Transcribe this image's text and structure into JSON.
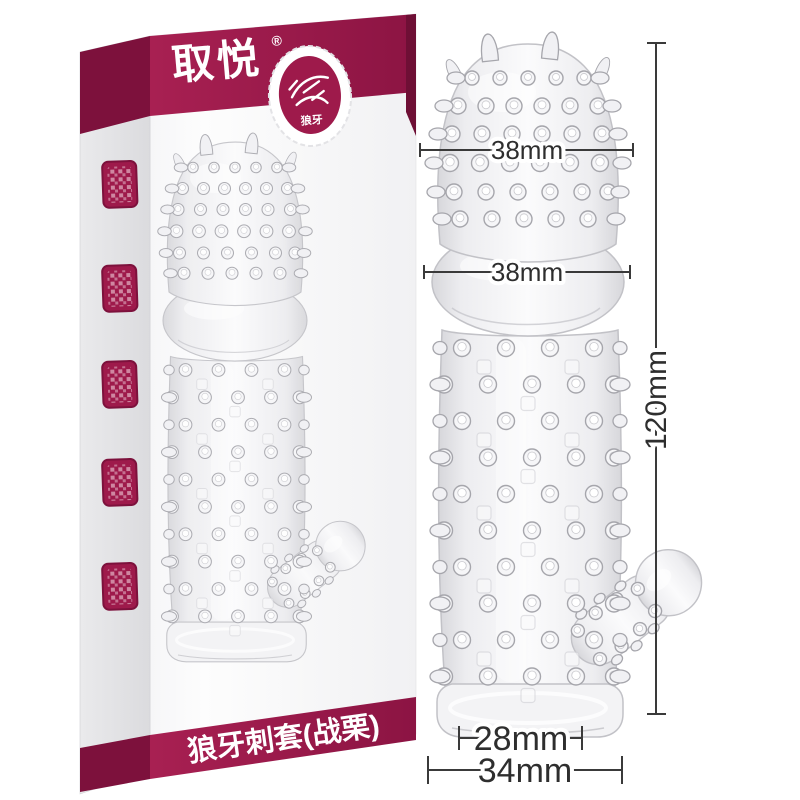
{
  "background_color": "#ffffff",
  "box": {
    "brand": "取悦",
    "registered_mark": "®",
    "badge": {
      "icon": "wolf-stamp-icon",
      "label": "狼牙"
    },
    "banner": "狼牙刺套(战栗)",
    "side_seals": [
      "seal-stamp",
      "seal-stamp",
      "seal-stamp",
      "seal-stamp",
      "seal-stamp"
    ],
    "colors": {
      "band": "#9e1a4b",
      "band_dark": "#7d113c"
    }
  },
  "measurements": {
    "head_width": "38mm",
    "glans_width": "38mm",
    "length": "120mm",
    "inner_opening": "28mm",
    "base_width": "34mm"
  },
  "colors": {
    "dimension_line": "#3a3a3a"
  }
}
